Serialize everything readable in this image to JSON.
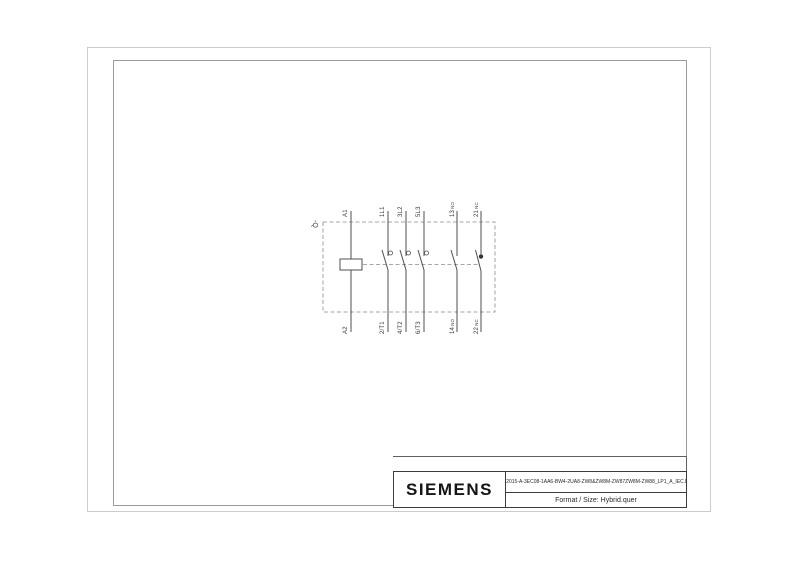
{
  "device_tag": "-Q",
  "terminals": {
    "coil": {
      "top": "A1",
      "bottom": "A2"
    },
    "poles": [
      {
        "top": "1L1",
        "bottom": "2/T1"
      },
      {
        "top": "3L2",
        "bottom": "4/T2"
      },
      {
        "top": "5L3",
        "bottom": "6/T3"
      }
    ],
    "aux": [
      {
        "top_num": "13",
        "top_type": "NO",
        "bottom_num": "14",
        "bottom_type": "NO"
      },
      {
        "top_num": "21",
        "top_type": "NC",
        "bottom_num": "22",
        "bottom_type": "NC"
      }
    ]
  },
  "title_block": {
    "brand": "SIEMENS",
    "drawing_file": "3RT2015-A-3EC08-1AA6-BW4-2UA8-ZW8&ZW8M-ZW87ZW8M-ZW88_LP1_A_IEC.DXF",
    "format_label": "Format / Size: Hybrid.quer"
  },
  "colors": {
    "conductor": "#4f4f4f",
    "dashed": "#8a8a8a",
    "frame_outer": "#cccccc",
    "frame_inner": "#9a9a9a",
    "label_text": "#3a3a3a"
  }
}
